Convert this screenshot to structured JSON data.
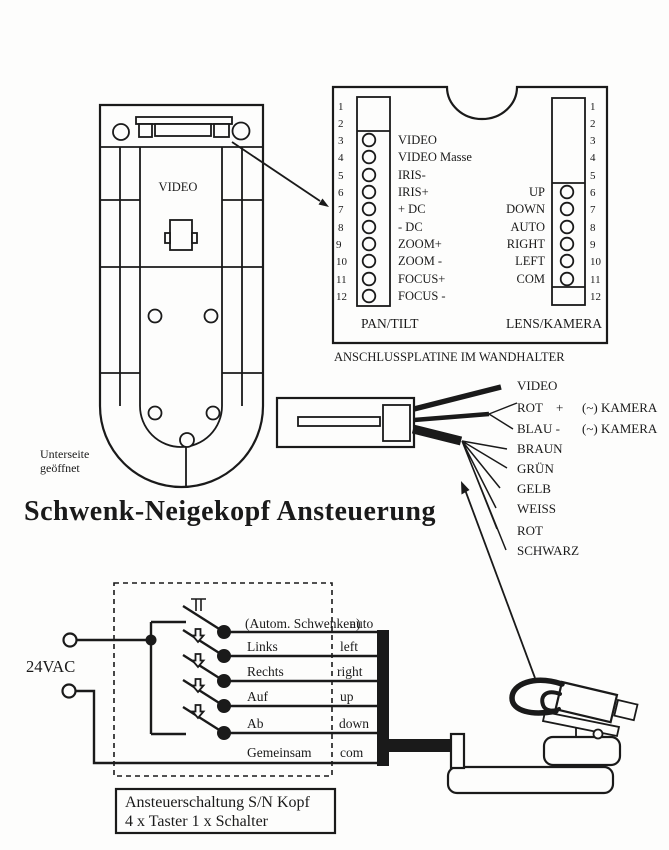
{
  "colors": {
    "ink": "#1a1a1a",
    "paper": "#fdfdfc"
  },
  "title": "Schwenk-Neigekopf Ansteuerung",
  "device": {
    "connector_label": "VIDEO",
    "caption_line1": "Unterseite",
    "caption_line2": "geöffnet"
  },
  "board": {
    "caption": "ANSCHLUSSPLATINE IM WANDHALTER",
    "pan_tilt": {
      "label": "PAN/TILT",
      "pin_numbers": [
        "1",
        "2",
        "3",
        "4",
        "5",
        "6",
        "7",
        "8",
        "9",
        "10",
        "11",
        "12"
      ],
      "pin_labels": [
        "VIDEO",
        "VIDEO Masse",
        "IRIS-",
        "IRIS+",
        "+ DC",
        "- DC",
        "ZOOM+",
        "ZOOM -",
        "FOCUS+",
        "FOCUS -"
      ]
    },
    "lens_kamera": {
      "label": "LENS/KAMERA",
      "pin_numbers": [
        "1",
        "2",
        "3",
        "4",
        "5",
        "6",
        "7",
        "8",
        "9",
        "10",
        "11",
        "12"
      ],
      "pin_labels": [
        "UP",
        "DOWN",
        "AUTO",
        "RIGHT",
        "LEFT",
        "COM"
      ]
    }
  },
  "wall_connector": {
    "wire_video": "VIDEO",
    "wire_rot": "ROT",
    "wire_rot_sign": "+",
    "wire_blau": "BLAU -",
    "kamera_note": "(~) KAMERA",
    "wire_colors": [
      "BRAUN",
      "GRÜN",
      "GELB",
      "WEISS",
      "ROT",
      "SCHWARZ"
    ]
  },
  "circuit": {
    "supply": "24VAC",
    "rows": [
      {
        "de": "(Autom. Schwenken)",
        "en": "auto"
      },
      {
        "de": "Links",
        "en": "left"
      },
      {
        "de": "Rechts",
        "en": "right"
      },
      {
        "de": "Auf",
        "en": "up"
      },
      {
        "de": "Ab",
        "en": "down"
      },
      {
        "de": "Gemeinsam",
        "en": "com"
      }
    ],
    "caption_line1": "Ansteuerschaltung S/N Kopf",
    "caption_line2": "4 x Taster 1 x Schalter"
  }
}
